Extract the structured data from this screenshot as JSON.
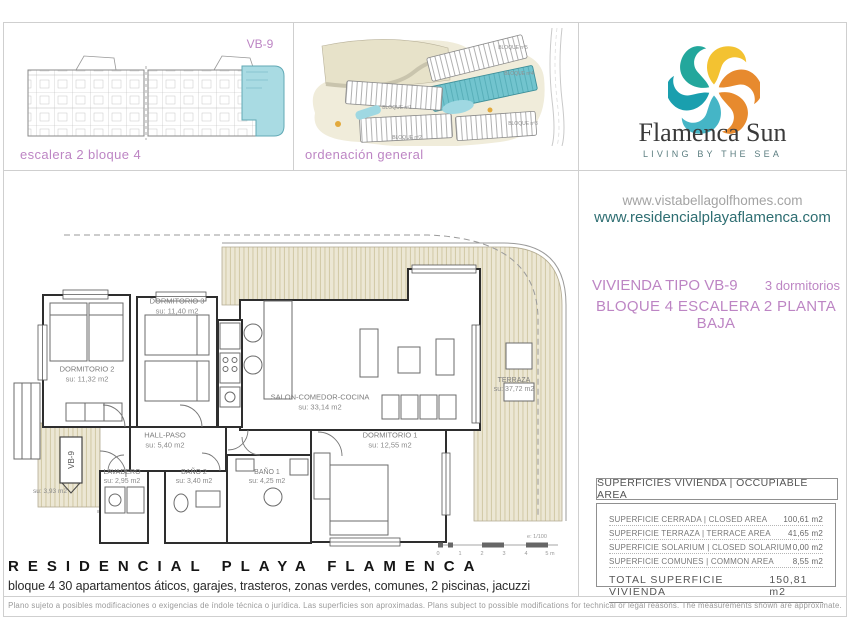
{
  "panels": {
    "block_plan": {
      "caption": "escalera 2 bloque 4",
      "unit_label": "VB-9"
    },
    "site_plan": {
      "caption": "ordenación general",
      "blocks": [
        "BLOQUE nº5",
        "BLOQUE nº4",
        "BLOQUE nº1",
        "BLOQUE nº2",
        "BLOQUE nº3"
      ]
    }
  },
  "brand": {
    "name": "Flamenca Sun",
    "tagline": "LIVING BY THE SEA",
    "url1": "www.vistabellagolfhomes.com",
    "url2": "www.residencialplayaflamenca.com"
  },
  "unit_info": {
    "type_label": "VIVIENDA TIPO VB-9",
    "bedrooms": "3 dormitorios",
    "location": "BLOQUE 4   ESCALERA 2   PLANTA BAJA"
  },
  "floor_plan": {
    "rooms": [
      {
        "name": "DORMITORIO 3",
        "area": "su: 11,40 m2"
      },
      {
        "name": "DORMITORIO 2",
        "area": "su: 11,32 m2"
      },
      {
        "name": "SALON-COMEDOR-COCINA",
        "area": "su: 33,14 m2"
      },
      {
        "name": "DORMITORIO 1",
        "area": "su: 12,55 m2"
      },
      {
        "name": "TERRAZA",
        "area": "su: 37,72 m2"
      },
      {
        "name": "HALL-PASO",
        "area": "su: 5,40 m2"
      },
      {
        "name": "LAVADERO",
        "area": "su: 2,95 m2"
      },
      {
        "name": "BAÑO 2",
        "area": "su: 3,40 m2"
      },
      {
        "name": "BAÑO 1",
        "area": "su: 4,25 m2"
      },
      {
        "name": "VB-9",
        "area": "su: 3,93 m2"
      }
    ],
    "scale_label": "e: 1/100",
    "scale_ticks": [
      "0",
      "1",
      "2",
      "3",
      "4",
      "5 m"
    ]
  },
  "areas_table": {
    "header": "SUPERFICIES VIVIENDA | OCCUPIABLE AREA",
    "rows": [
      {
        "label": "SUPERFICIE CERRADA | CLOSED AREA",
        "value": "100,61 m2"
      },
      {
        "label": "SUPERFICIE TERRAZA  | TERRACE AREA",
        "value": "41,65 m2"
      },
      {
        "label": "SUPERFICIE SOLARIUM | CLOSED SOLARIUM",
        "value": "0,00 m2"
      },
      {
        "label": "SUPERFICIE COMUNES | COMMON AREA",
        "value": "8,55 m2"
      }
    ],
    "total_label": "TOTAL SUPERFICIE VIVIENDA",
    "total_value": "150,81 m2"
  },
  "footer": {
    "title": "RESIDENCIAL PLAYA FLAMENCA",
    "subtitle": "bloque 4 30 apartamentos áticos, garajes, trasteros, zonas verdes, comunes, 2 piscinas, jacuzzi",
    "disclaimer": "Plano sujeto a posibles modificaciones o exigencias de índole técnica o jurídica. Las superficies son aproximadas. Plans subject to possible modifications for technical or legal reasons. The measurements shown are approximate."
  },
  "colors": {
    "accent_purple": "#bd85c4",
    "highlight_cyan": "#a9dbe3",
    "brand_teal": "#2e6e72",
    "logo_yellow": "#f3c231",
    "logo_orange": "#e78a2e",
    "logo_teal": "#1a9fae"
  }
}
